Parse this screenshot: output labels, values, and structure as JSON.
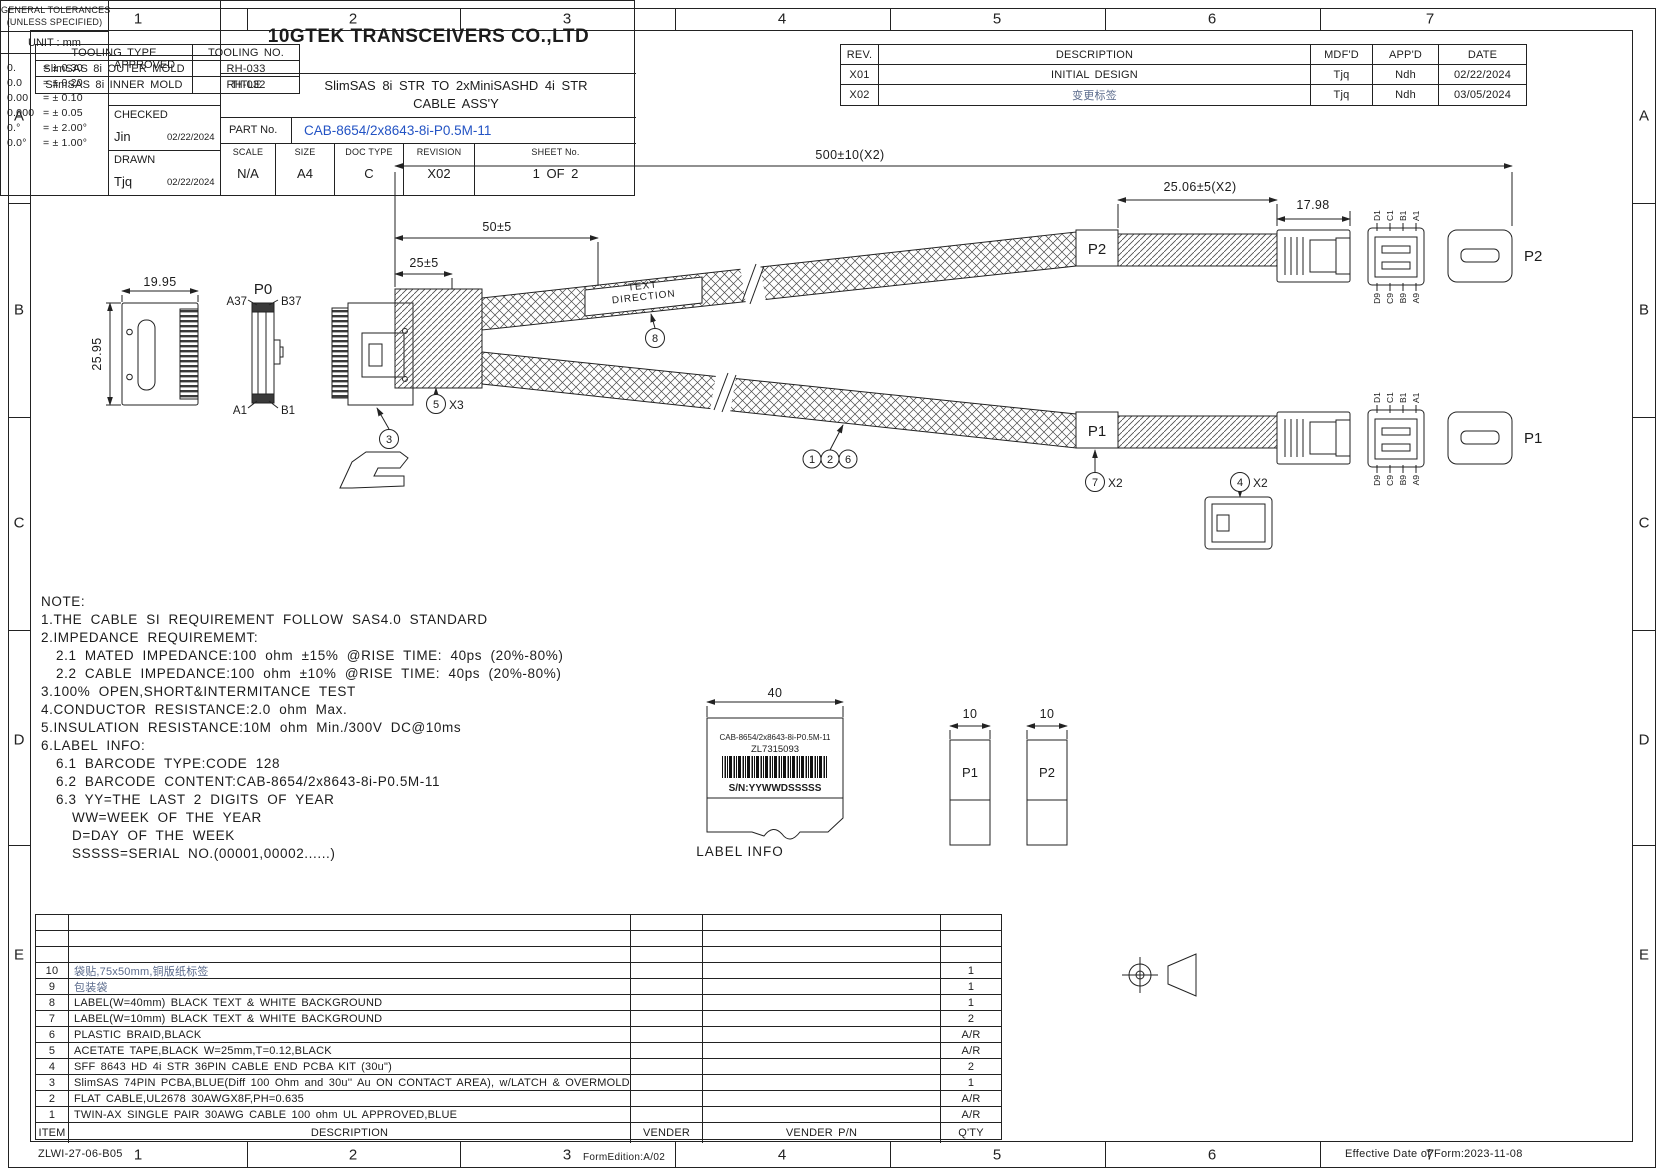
{
  "page": {
    "zones_cols": [
      "1",
      "2",
      "3",
      "4",
      "5",
      "6",
      "7"
    ],
    "zones_rows": [
      "A",
      "B",
      "C",
      "D",
      "E"
    ]
  },
  "tooling_table": {
    "headers": [
      "TOOLING TYPE",
      "TOOLING NO."
    ],
    "rows": [
      {
        "type": "SlimSAS 8i OUTER MOLD",
        "no": "RH-033"
      },
      {
        "type": "SlimSAS 8i INNER MOLD",
        "no": "RH-032"
      }
    ]
  },
  "revision_table": {
    "headers": [
      "REV.",
      "DESCRIPTION",
      "MDF'D",
      "APP'D",
      "DATE"
    ],
    "rows": [
      {
        "rev": "X01",
        "description": "INITIAL DESIGN",
        "mdfd": "Tjq",
        "appd": "Ndh",
        "date": "02/22/2024"
      },
      {
        "rev": "X02",
        "description": "变更标签",
        "mdfd": "Tjq",
        "appd": "Ndh",
        "date": "03/05/2024"
      }
    ]
  },
  "drawing": {
    "dims": {
      "overall": "500±10(X2)",
      "tape": "25.06±5(X2)",
      "conn": "17.98",
      "branch50": "50±5",
      "branch25": "25±5",
      "width": "19.95",
      "height": "25.95"
    },
    "labels": {
      "p0": "P0",
      "a37": "A37",
      "b37": "B37",
      "a1": "A1",
      "b1": "B1",
      "p1": "P1",
      "p2": "P2",
      "text_direction_1": "TEXT",
      "text_direction_2": "DIRECTION"
    },
    "pins": {
      "top": [
        "D1",
        "C1",
        "B1",
        "A1"
      ],
      "bottom": [
        "D9",
        "C9",
        "B9",
        "A9"
      ]
    },
    "balloons": {
      "b1": "1",
      "b2": "2",
      "b3": "3",
      "b4": "4",
      "b5": "5",
      "b6": "6",
      "b7": "7",
      "b8": "8",
      "x2": "X2",
      "x3": "X3"
    }
  },
  "notes": {
    "lines": [
      "NOTE:",
      "1.THE CABLE SI REQUIREMENT FOLLOW SAS4.0 STANDARD",
      "2.IMPEDANCE REQUIREMEMT:",
      "2.1 MATED IMPEDANCE:100 ohm ±15% @RISE TIME: 40ps (20%-80%)",
      "2.2 CABLE IMPEDANCE:100 ohm ±10% @RISE TIME: 40ps (20%-80%)",
      "3.100% OPEN,SHORT&INTERMITANCE TEST",
      "4.CONDUCTOR RESISTANCE:2.0 ohm Max.",
      "5.INSULATION RESISTANCE:10M ohm Min./300V DC@10ms",
      "6.LABEL INFO:",
      "6.1 BARCODE TYPE:CODE 128",
      "6.2 BARCODE CONTENT:CAB-8654/2x8643-8i-P0.5M-11",
      "6.3 YY=THE LAST 2 DIGITS OF YEAR",
      "WW=WEEK OF THE YEAR",
      "D=DAY OF THE WEEK",
      "SSSSS=SERIAL NO.(00001,00002......)"
    ]
  },
  "label_info": {
    "dim_width": "40",
    "small_dim_1": "10",
    "small_dim_2": "10",
    "line1": "CAB-8654/2x8643-8i-P0.5M-11",
    "line2": "ZL7315093",
    "sn": "S/N:YYWWDSSSSS",
    "caption": "LABEL INFO",
    "p1": "P1",
    "p2": "P2"
  },
  "bom": {
    "headers": {
      "item": "ITEM",
      "description": "DESCRIPTION",
      "vender": "VENDER",
      "vender_pn": "VENDER P/N",
      "qty": "Q'TY"
    },
    "rows": [
      {
        "item": "10",
        "description": "袋贴,75x50mm,铜版纸标签",
        "qty": "1"
      },
      {
        "item": "9",
        "description": "包装袋",
        "qty": "1"
      },
      {
        "item": "8",
        "description": "LABEL(W=40mm) BLACK TEXT & WHITE BACKGROUND",
        "qty": "1"
      },
      {
        "item": "7",
        "description": "LABEL(W=10mm) BLACK TEXT & WHITE BACKGROUND",
        "qty": "2"
      },
      {
        "item": "6",
        "description": "PLASTIC BRAID,BLACK",
        "qty": "A/R"
      },
      {
        "item": "5",
        "description": "ACETATE TAPE,BLACK W=25mm,T=0.12,BLACK",
        "qty": "A/R"
      },
      {
        "item": "4",
        "description": "SFF 8643 HD 4i STR 36PIN CABLE END PCBA KIT (30u\")",
        "qty": "2"
      },
      {
        "item": "3",
        "description": "SlimSAS 74PIN PCBA,BLUE(Diff 100 Ohm and 30u'' Au ON CONTACT AREA), w/LATCH & OVERMOLD",
        "qty": "1"
      },
      {
        "item": "2",
        "description": "FLAT CABLE,UL2678 30AWGX8F,PH=0.635",
        "qty": "A/R"
      },
      {
        "item": "1",
        "description": "TWIN-AX SINGLE PAIR 30AWG CABLE 100 ohm UL APPROVED,BLUE",
        "qty": "A/R"
      }
    ]
  },
  "title_block": {
    "tolerances": {
      "title": "GENERAL TOLERANCES",
      "subtitle": "(UNLESS SPECIFIED)",
      "unit": "UNIT : mm",
      "rows": [
        [
          "0.",
          "= ± 0.30"
        ],
        [
          "0.0",
          "= ± 0.20"
        ],
        [
          "0.00",
          "= ± 0.10"
        ],
        [
          "0.000",
          "= ± 0.05"
        ],
        [
          "0.°",
          "= ± 2.00°"
        ],
        [
          "0.0°",
          "= ± 1.00°"
        ]
      ]
    },
    "approved_label": "APPROVED",
    "checked_label": "CHECKED",
    "checked_by": "Jin",
    "checked_date": "02/22/2024",
    "drawn_label": "DRAWN",
    "drawn_by": "Tjq",
    "drawn_date": "02/22/2024",
    "company": "10GTEK TRANSCEIVERS CO.,LTD",
    "title_label": "TITLE",
    "title_line1": "SlimSAS 8i STR TO 2xMiniSASHD 4i STR",
    "title_line2": "CABLE ASS'Y",
    "part_label": "PART No.",
    "part_no": "CAB-8654/2x8643-8i-P0.5M-11",
    "scale_label": "SCALE",
    "scale": "N/A",
    "size_label": "SIZE",
    "size": "A4",
    "doc_label": "DOC TYPE",
    "doc": "C",
    "rev_label": "REVISION",
    "revision": "X02",
    "sheet_label": "SHEET No.",
    "sheet": "1 OF 2"
  },
  "footer": {
    "left": "ZLWI-27-06-B05",
    "center": "FormEdition:A/02",
    "right": "Effective Date of Form:2023-11-08"
  }
}
